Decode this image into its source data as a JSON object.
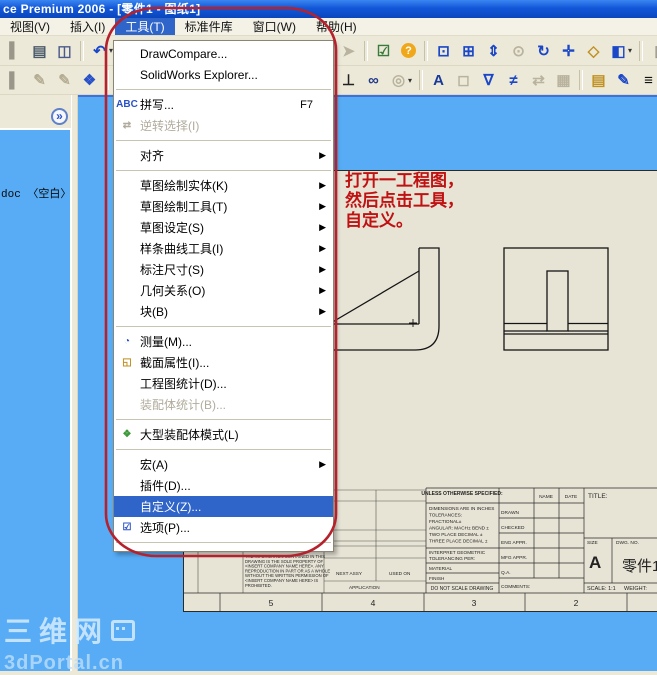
{
  "title_bar": {
    "title": "ce Premium 2006 - [零件1 - 图纸1]"
  },
  "menu_bar": {
    "items": [
      {
        "name": "view",
        "label": "视图(V)"
      },
      {
        "name": "insert",
        "label": "插入(I)"
      },
      {
        "name": "tools",
        "label": "工具(T)",
        "active": true
      },
      {
        "name": "library",
        "label": "标准件库"
      },
      {
        "name": "window",
        "label": "窗口(W)"
      },
      {
        "name": "help",
        "label": "帮助(H)"
      }
    ]
  },
  "toolbars": {
    "row1_left": [
      {
        "name": "partial-icon",
        "glyph": "▌",
        "color": "#9a968a"
      },
      {
        "name": "print-icon",
        "glyph": "▤",
        "color": "#4a5a6a"
      },
      {
        "name": "print-preview-icon",
        "glyph": "◫",
        "color": "#4a5a8a"
      },
      {
        "name": "undo-icon",
        "glyph": "↶",
        "color": "#1a47c8",
        "sep": true,
        "caret": true
      }
    ],
    "row1_right": [
      {
        "name": "selection-filter-icon",
        "glyph": "➤",
        "color": "#b8b29e"
      },
      {
        "name": "filter-toggle-icon",
        "glyph": "☑",
        "color": "#3a7a3a",
        "sep": true
      },
      {
        "name": "help-icon",
        "glyph": "?",
        "color": "#ffffff",
        "circle": true
      },
      {
        "name": "zoom-fit-icon",
        "glyph": "⊡",
        "color": "#1a47c8",
        "sep": true
      },
      {
        "name": "zoom-area-icon",
        "glyph": "⊞",
        "color": "#1a47c8"
      },
      {
        "name": "zoom-inout-icon",
        "glyph": "⇕",
        "color": "#1a47c8"
      },
      {
        "name": "zoom-selection-icon",
        "glyph": "⊙",
        "color": "#b8b29e"
      },
      {
        "name": "rotate-view-icon",
        "glyph": "↻",
        "color": "#1a47c8"
      },
      {
        "name": "pan-icon",
        "glyph": "✛",
        "color": "#1a47c8"
      },
      {
        "name": "3d-drawing-view-icon",
        "glyph": "◇",
        "color": "#c09020"
      },
      {
        "name": "view-orientation-icon",
        "glyph": "◧",
        "color": "#1a47c8",
        "caret": true
      },
      {
        "name": "partial-right-icon",
        "glyph": "▯",
        "color": "#9a968a",
        "sep": true
      }
    ],
    "row2_left": [
      {
        "name": "partial-icon-2",
        "glyph": "▌",
        "color": "#9a968a"
      },
      {
        "name": "sketch-icon",
        "glyph": "✎",
        "color": "#b5ad92"
      },
      {
        "name": "3d-sketch-icon",
        "glyph": "✎",
        "color": "#b5ad92"
      },
      {
        "name": "modify-sketch-icon",
        "glyph": "❖",
        "color": "#2a52c8"
      },
      {
        "name": "line-tool-icon",
        "glyph": "╲",
        "color": "#1a47c8",
        "sep": true
      }
    ],
    "row2_right": [
      {
        "name": "add-relation-icon",
        "glyph": "⊥",
        "color": "#222222"
      },
      {
        "name": "display-relations-icon",
        "glyph": "∞",
        "color": "#223a8a"
      },
      {
        "name": "auto-relations-icon",
        "glyph": "◎",
        "color": "#b8b29e",
        "caret": true
      },
      {
        "name": "note-icon",
        "glyph": "A",
        "color": "#1a3a9a",
        "sep": true
      },
      {
        "name": "balloon-icon",
        "glyph": "◻",
        "color": "#b8b29e"
      },
      {
        "name": "surface-finish-icon",
        "glyph": "∇",
        "color": "#1a47c8"
      },
      {
        "name": "weld-symbol-icon",
        "glyph": "≠",
        "color": "#1a47c8"
      },
      {
        "name": "dimension-arrows-icon",
        "glyph": "⇄",
        "color": "#b8b29e"
      },
      {
        "name": "hatch-icon",
        "glyph": "▦",
        "color": "#b8b29e"
      },
      {
        "name": "layer-properties-icon",
        "glyph": "▤",
        "color": "#c09020",
        "sep": true
      },
      {
        "name": "layer-color-icon",
        "glyph": "✎",
        "color": "#1a47c8"
      },
      {
        "name": "line-format-icon",
        "glyph": "≡",
        "color": "#111111"
      }
    ]
  },
  "left_panel": {
    "collapse_button": "»",
    "doc_label": "doc 〈空白〉"
  },
  "tools_menu": {
    "items": [
      {
        "id": "drawcompare",
        "label": "DrawCompare..."
      },
      {
        "id": "solidworks-explorer",
        "label": "SolidWorks Explorer..."
      },
      {
        "type": "sep"
      },
      {
        "id": "spelling",
        "label": "拼写...",
        "shortcut": "F7",
        "icon": {
          "name": "spell-check-icon",
          "glyph": "ABC",
          "color": "#2a52c8"
        }
      },
      {
        "id": "invert-selection",
        "label": "逆转选择(I)",
        "grayed": true,
        "icon": {
          "name": "invert-selection-icon",
          "glyph": "⇄",
          "color": "#a8a494"
        }
      },
      {
        "type": "sep"
      },
      {
        "id": "align",
        "label": "对齐",
        "submenu": true
      },
      {
        "type": "sep"
      },
      {
        "id": "sketch-entities",
        "label": "草图绘制实体(K)",
        "submenu": true
      },
      {
        "id": "sketch-tools",
        "label": "草图绘制工具(T)",
        "submenu": true
      },
      {
        "id": "sketch-settings",
        "label": "草图设定(S)",
        "submenu": true
      },
      {
        "id": "spline-tools",
        "label": "样条曲线工具(I)",
        "submenu": true
      },
      {
        "id": "dimensions",
        "label": "标注尺寸(S)",
        "submenu": true
      },
      {
        "id": "relations",
        "label": "几何关系(O)",
        "submenu": true
      },
      {
        "id": "blocks",
        "label": "块(B)",
        "submenu": true
      },
      {
        "type": "sep"
      },
      {
        "id": "measure",
        "label": "测量(M)...",
        "icon": {
          "name": "measure-icon",
          "glyph": "◔",
          "color": "#2a52c8"
        }
      },
      {
        "id": "section-properties",
        "label": "截面属性(I)...",
        "icon": {
          "name": "section-properties-icon",
          "glyph": "◱",
          "color": "#c09020"
        }
      },
      {
        "id": "drawing-statistics",
        "label": "工程图统计(D)..."
      },
      {
        "id": "assembly-statistics",
        "label": "装配体统计(B)...",
        "grayed": true
      },
      {
        "type": "sep"
      },
      {
        "id": "large-assembly-mode",
        "label": "大型装配体模式(L)",
        "icon": {
          "name": "large-assembly-mode-icon",
          "glyph": "❖",
          "color": "#3a9a3a"
        }
      },
      {
        "type": "sep"
      },
      {
        "id": "macro",
        "label": "宏(A)",
        "submenu": true
      },
      {
        "id": "add-ins",
        "label": "插件(D)..."
      },
      {
        "id": "customize",
        "label": "自定义(Z)...",
        "highlighted": true
      },
      {
        "id": "options",
        "label": "选项(P)...",
        "icon": {
          "name": "options-icon",
          "glyph": "☑",
          "color": "#2a52c8"
        }
      },
      {
        "type": "sep"
      },
      {
        "id": "customize-menu",
        "label": "自定义菜单(M)"
      }
    ]
  },
  "annotation": {
    "lines": [
      "打开一工程图，",
      "然后点击工具，",
      "自定义。"
    ],
    "text_color": "#c01212",
    "oval_color": "#b5212c"
  },
  "title_block": {
    "unless": "UNLESS OTHERWISE SPECIFIED:",
    "tolerances": [
      "DIMENSIONS ARE IN INCHES",
      "TOLERANCES:",
      "FRACTIONAL±",
      "ANGULAR: MACH±  BEND ±",
      "TWO PLACE DECIMAL    ±",
      "THREE PLACE DECIMAL  ±"
    ],
    "interpret_1": "INTERPRET GEOMETRIC",
    "interpret_2": "TOLERANCING PER:",
    "material": "MATERIAL",
    "finish": "FINISH",
    "do_not_scale": "DO NOT SCALE DRAWING",
    "name_header": "NAME",
    "date_header": "DATE",
    "rows": [
      "DRAWN",
      "CHECKED",
      "ENG APPR.",
      "MFG APPR.",
      "Q.A.",
      "COMMENTS:"
    ],
    "title_label": "TITLE:",
    "size_label": "SIZE",
    "size_value": "A",
    "dwg_label": "DWG. NO.",
    "dwg_value": "零件1",
    "scale": "SCALE: 1:1",
    "weight": "WEIGHT:",
    "proprietary_title": "PROPRIETARY AND CONFIDENTIAL",
    "proprietary_lines": [
      "THE INFORMATION CONTAINED IN THIS",
      "DRAWING IS THE SOLE PROPERTY OF",
      "<INSERT COMPANY NAME HERE>. ANY",
      "REPRODUCTION IN PART OR AS A WHOLE",
      "WITHOUT THE WRITTEN PERMISSION OF",
      "<INSERT COMPANY NAME HERE> IS",
      "PROHIBITED."
    ],
    "next_assy": "NEXT ASSY",
    "used_on": "USED ON",
    "application": "APPLICATION"
  },
  "zones": [
    "5",
    "4",
    "3",
    "2"
  ],
  "watermark": {
    "cn": "三维网",
    "en": "3dPortal.cn"
  }
}
